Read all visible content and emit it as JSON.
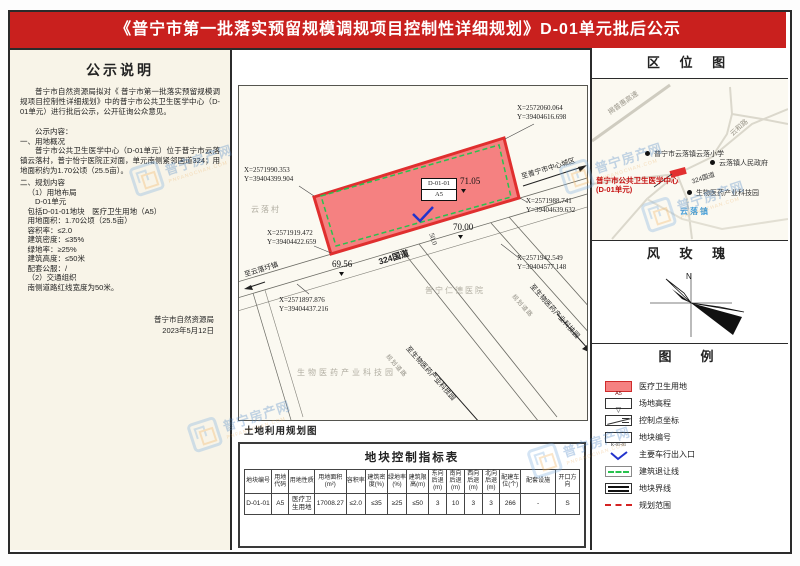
{
  "banner": {
    "title": "《普宁市第一批落实预留规模调规项目控制性详细规划》D-01单元批后公示"
  },
  "notice": {
    "title": "公示说明",
    "lines": [
      "普宁市自然资源局拟对《 普宁市第一批落实预留规模调规项目控制性详细规划》中的普宁市公共卫生医学中心（D-01单元）进行批后公示，公开征询公众意见。",
      "公示内容：",
      "一、用地概况",
      "普宁市公共卫生医学中心（D-01单元）位于普宁市云落镇云落村，普宁怡宁医院正对面，单元南侧紧邻国道324；用地面积约为1.70公顷（25.5亩）。",
      "二、规划内容",
      "（1）用地布局",
      "D-01单元",
      "包括D-01-01地块　医疗卫生用地（A5）",
      "用地面积：1.70公顷（25.5亩）",
      "容积率：≤2.0",
      "建筑密度：≤35%",
      "绿地率：≥25%",
      "建筑高度：≤50米",
      "配套公服：/",
      "（2）交通组织",
      "南侧道路红线宽度为50米。"
    ],
    "agency": "普宁市自然资源局",
    "date": "2023年5月12日"
  },
  "map": {
    "caption": "土地利用规划图",
    "parcel": {
      "code": "D-01-01",
      "use": "A5"
    },
    "elev": [
      "71.05",
      "70.00",
      "69.56"
    ],
    "coords": [
      {
        "x": "X=2572060.064",
        "y": "Y=39404616.698"
      },
      {
        "x": "X=2571990.353",
        "y": "Y=39404399.904"
      },
      {
        "x": "X=2571919.472",
        "y": "Y=39404422.659"
      },
      {
        "x": "X=2571988.741",
        "y": "Y=39404639.632"
      },
      {
        "x": "X=2571942.549",
        "y": "Y=39404577.148"
      },
      {
        "x": "X=2571897.876",
        "y": "Y=39404437.216"
      }
    ],
    "labels": {
      "village": "云落村",
      "hospital": "普宁仁德医院",
      "biopark": "生物医药产业科技园",
      "road": "324国道",
      "road_width": "50.0",
      "dir_city": "至普宁市中心城区",
      "dir_town": "至云落圩镇",
      "dir_biopark": "至生物医药产业科技园",
      "side_road": "规划道路"
    }
  },
  "location_map": {
    "title": "区 位 图",
    "labels": {
      "highway": "揭普惠高速",
      "yunhe_road": "云和路",
      "school": "普宁市云落镇云落小学",
      "government": "云落镇人民政府",
      "center": "普宁市公共卫生医学中心 (D-01单元)",
      "road": "324国道",
      "biopark": "生物医药产业科技园",
      "town": "云落镇"
    }
  },
  "wind_rose": {
    "title": "风 玫 瑰",
    "north": "N"
  },
  "legend": {
    "title": "图　例",
    "items": [
      {
        "tag": "A5",
        "label": "医疗卫生用地"
      },
      {
        "tag": "▽",
        "label": "场地高程"
      },
      {
        "tag": "",
        "label": "控制点坐标"
      },
      {
        "tag": "K-01-01",
        "label": "地块编号"
      },
      {
        "tag": "",
        "label": "主要车行出入口"
      },
      {
        "tag": "",
        "label": "建筑退让线"
      },
      {
        "tag": "",
        "label": "地块界线"
      },
      {
        "tag": "",
        "label": "规划范围"
      }
    ]
  },
  "table": {
    "title": "地块控制指标表",
    "headers": [
      "地块编号",
      "用地代码",
      "用地性质",
      "用地面积(m²)",
      "容积率",
      "建筑密度(%)",
      "绿地率(%)",
      "建筑限高(m)",
      "东向后退(m)",
      "南向后退(m)",
      "西向后退(m)",
      "北向后退(m)",
      "配建车位(个)",
      "配套设施",
      "开口方向"
    ],
    "row": [
      "D-01-01",
      "A5",
      "医疗卫生用地",
      "17008.27",
      "≤2.0",
      "≤35",
      "≥25",
      "≤50",
      "3",
      "10",
      "3",
      "3",
      "266",
      "-",
      "S"
    ]
  },
  "watermark": {
    "cn": "普宁房产网",
    "en": "PNFANGCHAN.COM"
  }
}
